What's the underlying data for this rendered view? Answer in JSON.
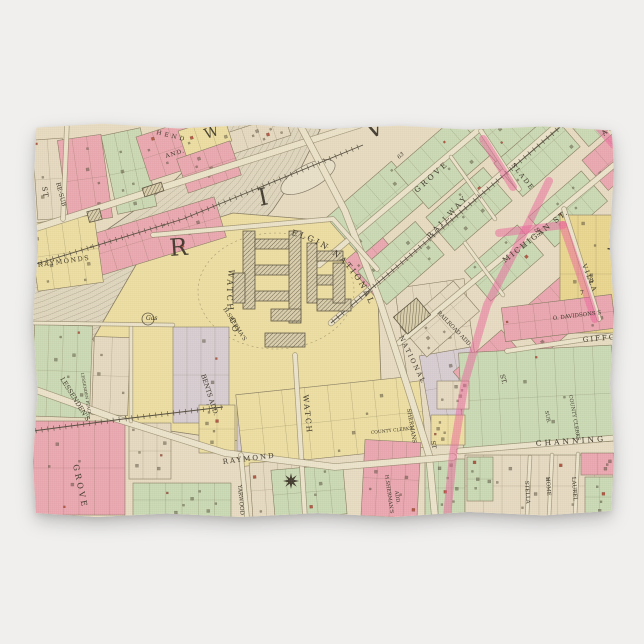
{
  "product": {
    "background_color": "#f0efed",
    "item": "kitchen-towel-with-vintage-plat-map"
  },
  "map": {
    "colors": {
      "paper": "#ece2c9",
      "street": "#f1e9d2",
      "street_edge": "#8b8166",
      "pink": "#f0a9b6",
      "green": "#cddfba",
      "yellow": "#f2e4a6",
      "deep_yellow": "#eedb92",
      "cream": "#eadfc8",
      "lavender": "#dcd2da",
      "river": "#e4dcc6",
      "river_line": "#7d7464",
      "pink_road": "#f25f9f",
      "rail": "#4c463a",
      "ink": "#332e23",
      "brick": "#b5523f"
    },
    "river": {
      "centerline": [
        [
          246,
          -14
        ],
        [
          228,
          22
        ],
        [
          204,
          58
        ],
        [
          174,
          90
        ],
        [
          138,
          118
        ],
        [
          98,
          146
        ],
        [
          56,
          168
        ],
        [
          12,
          186
        ],
        [
          -14,
          194
        ]
      ],
      "half_width": 46
    },
    "island": {
      "cx": 275,
      "cy": 54,
      "rx": 30,
      "ry": 12,
      "rot": -28
    },
    "watch_parcel": {
      "points": [
        [
          60,
          216
        ],
        [
          118,
          116
        ],
        [
          200,
          90
        ],
        [
          298,
          98
        ],
        [
          344,
          148
        ],
        [
          350,
          312
        ],
        [
          206,
          318
        ],
        [
          96,
          302
        ]
      ],
      "arc_text_top": "ELGIN NATIONAL",
      "arc_text_left": "WATCH CO.",
      "factory_buildings": [
        [
          210,
          108,
          12,
          78
        ],
        [
          222,
          116,
          34,
          10
        ],
        [
          222,
          142,
          34,
          10
        ],
        [
          222,
          168,
          34,
          10
        ],
        [
          256,
          108,
          12,
          92
        ],
        [
          238,
          186,
          30,
          12
        ],
        [
          274,
          120,
          10,
          60
        ],
        [
          284,
          128,
          26,
          10
        ],
        [
          284,
          152,
          26,
          10
        ],
        [
          284,
          176,
          34,
          12
        ],
        [
          300,
          140,
          12,
          40
        ],
        [
          232,
          210,
          40,
          14
        ],
        [
          200,
          150,
          12,
          30
        ]
      ]
    },
    "dark_buildings": [
      [
        55,
        87,
        13,
        11,
        -14
      ],
      [
        110,
        62,
        20,
        9,
        -18
      ],
      [
        364,
        182,
        30,
        22,
        -40
      ]
    ],
    "gas_works": {
      "cx": 115,
      "cy": 196,
      "r": 6,
      "label": "Gas"
    },
    "compass": {
      "cx": 258,
      "cy": 358,
      "r": 8
    },
    "blocks": [
      [
        2,
        16,
        30,
        80,
        -4,
        "cream"
      ],
      [
        30,
        14,
        44,
        84,
        -8,
        "pink"
      ],
      [
        76,
        8,
        40,
        80,
        -12,
        "green"
      ],
      [
        108,
        0,
        84,
        46,
        -18,
        "pink"
      ],
      [
        196,
        0,
        60,
        22,
        -18,
        "cream"
      ],
      [
        148,
        0,
        48,
        26,
        -18,
        "yellow"
      ],
      [
        60,
        92,
        130,
        42,
        -17,
        "pink"
      ],
      [
        148,
        26,
        56,
        36,
        -19,
        "pink"
      ],
      [
        0,
        96,
        66,
        68,
        -8,
        "yellow"
      ],
      [
        0,
        202,
        58,
        92,
        2,
        "green"
      ],
      [
        60,
        214,
        36,
        78,
        2,
        "cream"
      ],
      [
        140,
        204,
        56,
        96,
        0,
        "lavender"
      ],
      [
        0,
        298,
        92,
        94,
        0,
        "pink"
      ],
      [
        96,
        300,
        42,
        56,
        0,
        "cream"
      ],
      [
        100,
        360,
        98,
        34,
        0,
        "green"
      ],
      [
        204,
        276,
        34,
        52,
        0,
        "lavender"
      ],
      [
        206,
        262,
        184,
        72,
        -6,
        "yellow"
      ],
      [
        166,
        282,
        36,
        48,
        0,
        "yellow"
      ],
      [
        330,
        318,
        56,
        76,
        3,
        "pink"
      ],
      [
        392,
        336,
        40,
        58,
        0,
        "green"
      ],
      [
        218,
        338,
        56,
        56,
        -4,
        "cream"
      ],
      [
        240,
        344,
        72,
        50,
        -5,
        "green"
      ],
      [
        322,
        118,
        44,
        48,
        -40,
        "pink"
      ],
      [
        368,
        160,
        70,
        95,
        -8,
        "cream"
      ],
      [
        392,
        228,
        52,
        70,
        -10,
        "lavender"
      ],
      [
        300,
        60,
        86,
        52,
        -41,
        "green"
      ],
      [
        368,
        12,
        86,
        52,
        -41,
        "green"
      ],
      [
        436,
        -34,
        86,
        52,
        -41,
        "green"
      ],
      [
        330,
        118,
        76,
        44,
        -41,
        "green"
      ],
      [
        398,
        64,
        76,
        44,
        -41,
        "green"
      ],
      [
        466,
        10,
        76,
        44,
        -41,
        "green"
      ],
      [
        532,
        -40,
        76,
        44,
        -41,
        "green"
      ],
      [
        372,
        176,
        70,
        40,
        -41,
        "cream"
      ],
      [
        436,
        120,
        70,
        40,
        -41,
        "green"
      ],
      [
        500,
        66,
        70,
        40,
        -41,
        "green"
      ],
      [
        556,
        16,
        50,
        40,
        -41,
        "pink"
      ],
      [
        428,
        222,
        64,
        48,
        -41,
        "pink"
      ],
      [
        488,
        168,
        64,
        48,
        -41,
        "pink"
      ],
      [
        544,
        118,
        50,
        44,
        -41,
        "cream"
      ],
      [
        527,
        92,
        54,
        118,
        0,
        "deep_yellow"
      ],
      [
        470,
        178,
        111,
        34,
        -7,
        "pink"
      ],
      [
        428,
        226,
        153,
        96,
        -3,
        "green"
      ],
      [
        398,
        292,
        34,
        30,
        0,
        "yellow"
      ],
      [
        404,
        258,
        32,
        28,
        0,
        "cream"
      ],
      [
        432,
        332,
        148,
        62,
        0,
        "cream"
      ],
      [
        548,
        330,
        33,
        22,
        0,
        "pink"
      ],
      [
        552,
        354,
        29,
        40,
        0,
        "green"
      ],
      [
        434,
        334,
        26,
        44,
        0,
        "green"
      ]
    ],
    "streets": [
      {
        "pts": [
          [
            0,
            106
          ],
          [
            150,
            58
          ],
          [
            332,
            0
          ]
        ],
        "w": 6
      },
      {
        "pts": [
          [
            286,
            142
          ],
          [
            470,
            -14
          ]
        ],
        "w": 5
      },
      {
        "pts": [
          [
            298,
            200
          ],
          [
            540,
            -12
          ]
        ],
        "w": 5
      },
      {
        "pts": [
          [
            366,
            220
          ],
          [
            581,
            42
          ]
        ],
        "w": 5
      },
      {
        "pts": [
          [
            266,
            0
          ],
          [
            312,
            88
          ],
          [
            346,
            176
          ],
          [
            374,
            262
          ],
          [
            396,
            332
          ],
          [
            402,
            394
          ]
        ],
        "w": 6
      },
      {
        "pts": [
          [
            262,
            232
          ],
          [
            272,
            394
          ]
        ],
        "w": 4
      },
      {
        "pts": [
          [
            0,
            266
          ],
          [
            84,
            296
          ],
          [
            192,
            330
          ],
          [
            302,
            344
          ],
          [
            420,
            334
          ]
        ],
        "w": 6
      },
      {
        "pts": [
          [
            426,
            328
          ],
          [
            581,
            315
          ]
        ],
        "w": 5
      },
      {
        "pts": [
          [
            474,
            228
          ],
          [
            581,
            212
          ]
        ],
        "w": 4
      },
      {
        "pts": [
          [
            497,
            334
          ],
          [
            494,
            394
          ]
        ],
        "w": 3
      },
      {
        "pts": [
          [
            519,
            332
          ],
          [
            516,
            394
          ]
        ],
        "w": 3
      },
      {
        "pts": [
          [
            545,
            331
          ],
          [
            542,
            394
          ]
        ],
        "w": 3
      },
      {
        "pts": [
          [
            531,
            86
          ],
          [
            566,
            196
          ]
        ],
        "w": 4
      },
      {
        "pts": [
          [
            208,
            332
          ],
          [
            214,
            394
          ]
        ],
        "w": 4
      },
      {
        "pts": [
          [
            448,
            8
          ],
          [
            486,
            66
          ]
        ],
        "w": 4
      },
      {
        "pts": [
          [
            418,
            34
          ],
          [
            462,
            96
          ]
        ],
        "w": 3
      },
      {
        "pts": [
          [
            432,
            120
          ],
          [
            470,
            172
          ]
        ],
        "w": 3
      },
      {
        "pts": [
          [
            120,
            112
          ],
          [
            300,
            96
          ],
          [
            344,
            146
          ]
        ],
        "w": 4
      },
      {
        "pts": [
          [
            34,
            0
          ],
          [
            30,
            96
          ]
        ],
        "w": 4
      },
      {
        "pts": [
          [
            98,
            202
          ],
          [
            98,
            298
          ]
        ],
        "w": 3
      },
      {
        "pts": [
          [
            0,
            200
          ],
          [
            140,
            202
          ]
        ],
        "w": 3
      }
    ],
    "railroads": [
      {
        "pts": [
          [
            0,
            142
          ],
          [
            150,
            96
          ],
          [
            330,
            22
          ]
        ]
      },
      {
        "pts": [
          [
            298,
            200
          ],
          [
            560,
            -24
          ]
        ]
      },
      {
        "pts": [
          [
            0,
            308
          ],
          [
            90,
            296
          ],
          [
            190,
            284
          ]
        ]
      }
    ],
    "pink_roads": [
      [
        [
          516,
          58
        ],
        [
          486,
          120
        ],
        [
          454,
          182
        ],
        [
          432,
          258
        ],
        [
          420,
          332
        ],
        [
          414,
          394
        ]
      ],
      [
        [
          466,
          110
        ],
        [
          530,
          102
        ]
      ],
      [
        [
          530,
          102
        ],
        [
          546,
          148
        ],
        [
          562,
          196
        ]
      ],
      [
        [
          450,
          16
        ],
        [
          480,
          64
        ]
      ],
      [
        [
          562,
          0
        ],
        [
          581,
          22
        ]
      ]
    ],
    "labels": [
      [
        "R",
        137,
        133,
        -4,
        24,
        0,
        "big"
      ],
      [
        "I",
        227,
        83,
        -12,
        24,
        0,
        "big"
      ],
      [
        "V",
        336,
        16,
        -20,
        24,
        0,
        "big"
      ],
      [
        "W",
        173,
        16,
        -18,
        14,
        0,
        "big"
      ],
      [
        "H",
        573,
        126,
        8,
        26,
        0,
        "big"
      ],
      [
        "HEND",
        123,
        11,
        14,
        6,
        3,
        ""
      ],
      [
        "AND.",
        133,
        35,
        -17,
        6,
        1,
        ""
      ],
      [
        "RE-SUB",
        23,
        60,
        75,
        6,
        0,
        ""
      ],
      [
        "ST",
        9,
        64,
        80,
        7,
        1,
        ""
      ],
      [
        "RAYMONDS",
        5,
        144,
        -8,
        6.5,
        1.5,
        ""
      ],
      [
        "LESSENDEN'S",
        27,
        256,
        58,
        6.5,
        0,
        ""
      ],
      [
        "LESSENDEN PLACE",
        48,
        250,
        80,
        4,
        0,
        ""
      ],
      [
        "BENTS ADD.",
        168,
        252,
        72,
        6.5,
        0,
        ""
      ],
      [
        "GROVE",
        40,
        342,
        78,
        8,
        3,
        ""
      ],
      [
        "RAYMOND",
        190,
        341,
        -7,
        7,
        2,
        ""
      ],
      [
        "YARWOOD",
        205,
        362,
        85,
        5.5,
        0,
        ""
      ],
      [
        "WATCH",
        270,
        272,
        84,
        7.5,
        2,
        ""
      ],
      [
        "H.SHERMAN'S",
        352,
        352,
        82,
        5,
        0,
        ""
      ],
      [
        "ADD.",
        362,
        368,
        82,
        5,
        0,
        ""
      ],
      [
        "H.SHERMA'S",
        190,
        186,
        57,
        5.5,
        0,
        ""
      ],
      [
        "NATIONAL",
        366,
        214,
        64,
        6.5,
        2,
        ""
      ],
      [
        "RAILROAD ADD.",
        404,
        190,
        46,
        5.5,
        0,
        ""
      ],
      [
        "SHERMANS",
        374,
        286,
        80,
        5.5,
        0,
        ""
      ],
      [
        "RAILWAY",
        397,
        116,
        -47,
        7.5,
        3,
        ""
      ],
      [
        "GROVE",
        384,
        70,
        -42,
        7.5,
        3,
        ""
      ],
      [
        "MICHIGAN ST.",
        472,
        140,
        -38,
        7.5,
        2,
        ""
      ],
      [
        "SLADE",
        478,
        42,
        52,
        6.5,
        2,
        ""
      ],
      [
        "VILLA",
        549,
        142,
        68,
        6.5,
        2,
        ""
      ],
      [
        "AV",
        571,
        13,
        -40,
        7,
        1,
        ""
      ],
      [
        "ST.",
        501,
        106,
        62,
        6.5,
        0,
        ""
      ],
      [
        "ST.",
        467,
        252,
        74,
        6.5,
        0,
        ""
      ],
      [
        "ST",
        398,
        318,
        80,
        6,
        0,
        ""
      ],
      [
        "O. DAVIDSONS S",
        520,
        197,
        -7,
        5.5,
        0,
        ""
      ],
      [
        "GIFFORD",
        550,
        219,
        -5,
        7,
        2,
        ""
      ],
      [
        "COUNTY CLERKS",
        536,
        272,
        80,
        5,
        0,
        ""
      ],
      [
        "SUB.",
        512,
        288,
        80,
        5,
        0,
        ""
      ],
      [
        "CHANNING",
        503,
        323,
        -4,
        7.5,
        3,
        ""
      ],
      [
        "STELLA",
        492,
        358,
        86,
        5.5,
        0,
        ""
      ],
      [
        "HOME",
        513,
        354,
        86,
        5.5,
        0,
        ""
      ],
      [
        "LAUREL",
        539,
        354,
        86,
        5.5,
        0,
        ""
      ],
      [
        "8",
        556,
        160,
        0,
        7,
        0,
        ""
      ],
      [
        "7",
        547,
        172,
        0,
        6,
        0,
        ""
      ],
      [
        "63",
        366,
        36,
        -40,
        5.5,
        0,
        "i"
      ],
      [
        "COUNTY CLERKS",
        338,
        311,
        -6,
        4.5,
        0,
        ""
      ],
      [
        "Gas",
        113,
        197,
        0,
        6,
        0,
        "i"
      ]
    ]
  }
}
